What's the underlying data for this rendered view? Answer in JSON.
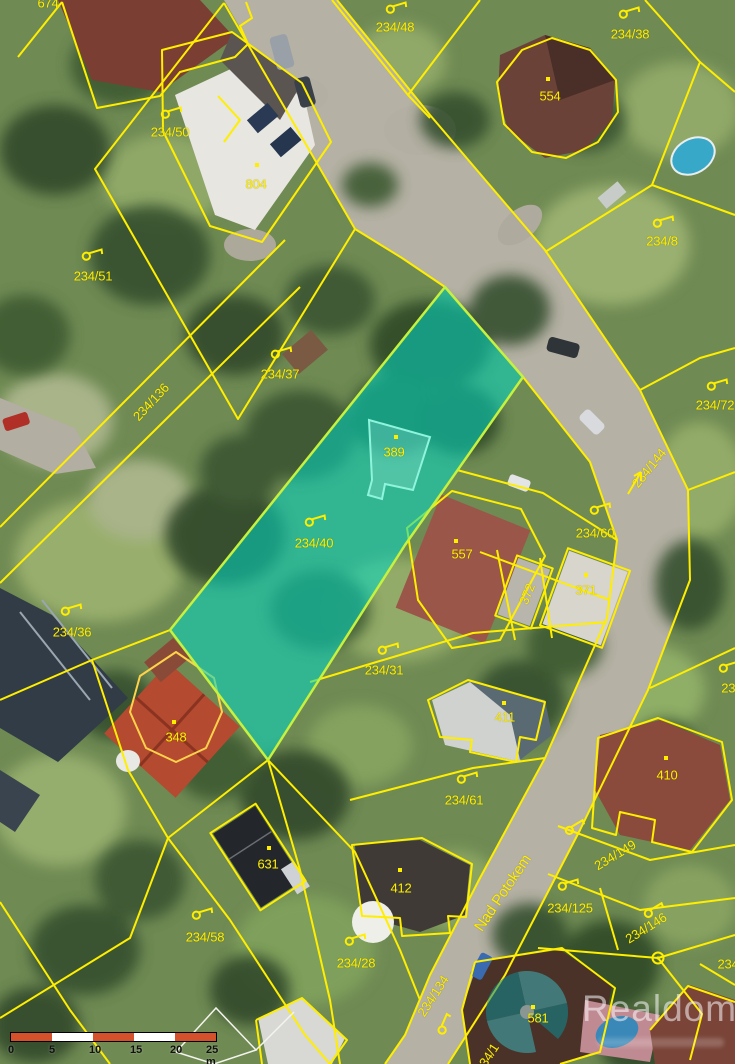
{
  "map": {
    "kind": "cadastral-aerial-map",
    "boundary_color": "#ffee00",
    "highlight_fill": "#00d8c4",
    "highlight_edge": "#c6f13e",
    "scalebar_color": "#d4512c"
  },
  "highlighted_parcel": {
    "parcel_label": "234/40",
    "building_label": "389"
  },
  "street": {
    "name": "Nad Potokem"
  },
  "parcels": [
    {
      "label": "674",
      "x": 48,
      "y": 3,
      "kind": "building"
    },
    {
      "label": "234/48",
      "x": 395,
      "y": 27,
      "flag": [
        396,
        8,
        -8
      ]
    },
    {
      "label": "234/38",
      "x": 630,
      "y": 34,
      "flag": [
        629,
        13,
        -8
      ]
    },
    {
      "label": "554",
      "x": 550,
      "y": 96,
      "kind": "building",
      "dot": [
        548,
        79
      ]
    },
    {
      "label": "234/50",
      "x": 170,
      "y": 132,
      "flag": [
        171,
        113,
        -8
      ]
    },
    {
      "label": "804",
      "x": 256,
      "y": 184,
      "kind": "building",
      "dot": [
        257,
        165
      ]
    },
    {
      "label": "234/8",
      "x": 662,
      "y": 241,
      "flag": [
        663,
        222,
        -8
      ]
    },
    {
      "label": "234/51",
      "x": 93,
      "y": 276,
      "flag": [
        92,
        255,
        -8
      ]
    },
    {
      "label": "234/37",
      "x": 280,
      "y": 374,
      "flag": [
        281,
        353,
        -8
      ]
    },
    {
      "label": "234/136",
      "x": 151,
      "y": 402,
      "rot": -47
    },
    {
      "label": "234/72",
      "x": 715,
      "y": 405,
      "flag": [
        717,
        385,
        -8
      ]
    },
    {
      "label": "234/144",
      "x": 649,
      "y": 468,
      "rot": -51,
      "arrow": [
        641,
        470,
        628,
        492
      ]
    },
    {
      "label": "389",
      "x": 394,
      "y": 452,
      "kind": "building-highlight",
      "dot": [
        396,
        437
      ]
    },
    {
      "label": "234/40",
      "x": 314,
      "y": 543,
      "kind": "parcel-highlight",
      "flag": [
        315,
        521,
        -8
      ]
    },
    {
      "label": "557",
      "x": 462,
      "y": 554,
      "kind": "building",
      "dot": [
        456,
        541
      ]
    },
    {
      "label": "234/60",
      "x": 595,
      "y": 533,
      "flag": [
        600,
        509,
        -8
      ]
    },
    {
      "label": "372",
      "x": 527,
      "y": 594,
      "rot": -68,
      "kind": "building"
    },
    {
      "label": "371",
      "x": 586,
      "y": 590,
      "kind": "building",
      "dot": [
        586,
        575
      ]
    },
    {
      "label": "234/36",
      "x": 72,
      "y": 632,
      "flag": [
        71,
        610,
        -8
      ]
    },
    {
      "label": "234/31",
      "x": 384,
      "y": 670,
      "flag": [
        388,
        649,
        -8
      ]
    },
    {
      "label": "348",
      "x": 176,
      "y": 737,
      "kind": "building",
      "dot": [
        174,
        722
      ]
    },
    {
      "label": "411",
      "x": 505,
      "y": 717,
      "kind": "building",
      "dot": [
        504,
        703
      ]
    },
    {
      "label": "410",
      "x": 667,
      "y": 775,
      "kind": "building",
      "dot": [
        666,
        758
      ]
    },
    {
      "label": "234/61",
      "x": 464,
      "y": 800,
      "flag": [
        467,
        778,
        -8
      ]
    },
    {
      "label": "234/1",
      "x": 737,
      "y": 688,
      "flag": [
        729,
        667,
        -8
      ]
    },
    {
      "label": "631",
      "x": 268,
      "y": 864,
      "kind": "building",
      "dot": [
        269,
        848
      ]
    },
    {
      "label": "412",
      "x": 401,
      "y": 888,
      "kind": "building",
      "dot": [
        400,
        870
      ]
    },
    {
      "label": "Nad Potokem",
      "x": 503,
      "y": 893,
      "rot": -56,
      "kind": "street"
    },
    {
      "label": "234/149",
      "x": 615,
      "y": 855,
      "rot": -31,
      "flag": [
        573,
        831,
        -22
      ]
    },
    {
      "label": "234/125",
      "x": 570,
      "y": 908,
      "flag": [
        568,
        885,
        -8
      ]
    },
    {
      "label": "234/146",
      "x": 646,
      "y": 928,
      "rot": -32,
      "flag": [
        652,
        914,
        -22
      ]
    },
    {
      "label": "234/58",
      "x": 205,
      "y": 937,
      "flag": [
        202,
        914,
        -8
      ]
    },
    {
      "label": "234/28",
      "x": 356,
      "y": 963,
      "flag": [
        355,
        940,
        -8
      ]
    },
    {
      "label": "234/134",
      "x": 433,
      "y": 996,
      "rot": -57
    },
    {
      "label": "581",
      "x": 538,
      "y": 1018,
      "kind": "building",
      "dot": [
        533,
        1007
      ]
    },
    {
      "label": "234",
      "x": 728,
      "y": 964
    },
    {
      "label": "234/1",
      "x": 487,
      "y": 1058,
      "rot": -57,
      "flag": [
        443,
        1037,
        -58
      ]
    }
  ],
  "scale_bar": {
    "ticks": [
      "0",
      "5",
      "10",
      "15",
      "20",
      "25 m"
    ],
    "segments": 5
  },
  "watermark": {
    "name": "Realdomus"
  }
}
